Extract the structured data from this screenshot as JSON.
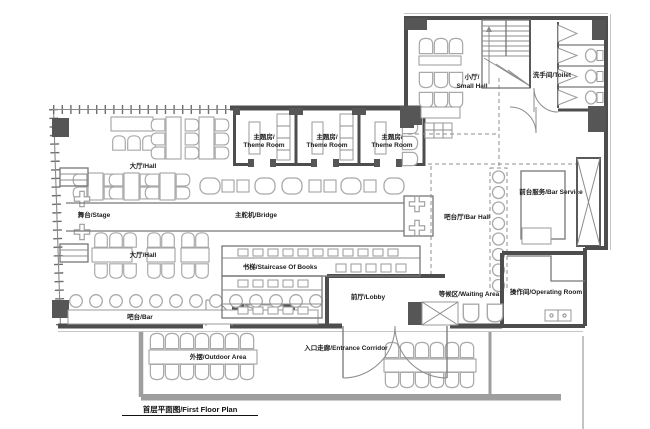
{
  "title": {
    "plan_title": "首层平面图/First Floor Plan"
  },
  "labels": {
    "small_hall_zh": "小厅/",
    "small_hall_en": "Small Hall",
    "toilet": "洗手间/Toilet",
    "theme_room_zh": "主题房/",
    "theme_room_en": "Theme Room",
    "hall": "大厅/Hall",
    "stage": "舞台/Stage",
    "bridge": "主舵机/Bridge",
    "bar_hall": "吧台厅/Bar Hall",
    "bar_service": "前台服务/Bar Service",
    "operating_room": "操作间/Operating Room",
    "waiting_area": "等候区/Waiting Area",
    "staircase_of_books": "书梯/Staircase Of Books",
    "lobby": "前厅/Lobby",
    "entrance_corridor": "入口走廊/Entrance Corridor",
    "bar_counter": "吧台/Bar",
    "outdoor_area": "外摆/Outdoor Area"
  },
  "colors": {
    "wall": "#4d4d4d",
    "furniture": "#a9a9a9",
    "site_boundary": "#9e9e9e",
    "dashed_zone": "#8f8f8f",
    "text": "#1c1c1c"
  }
}
